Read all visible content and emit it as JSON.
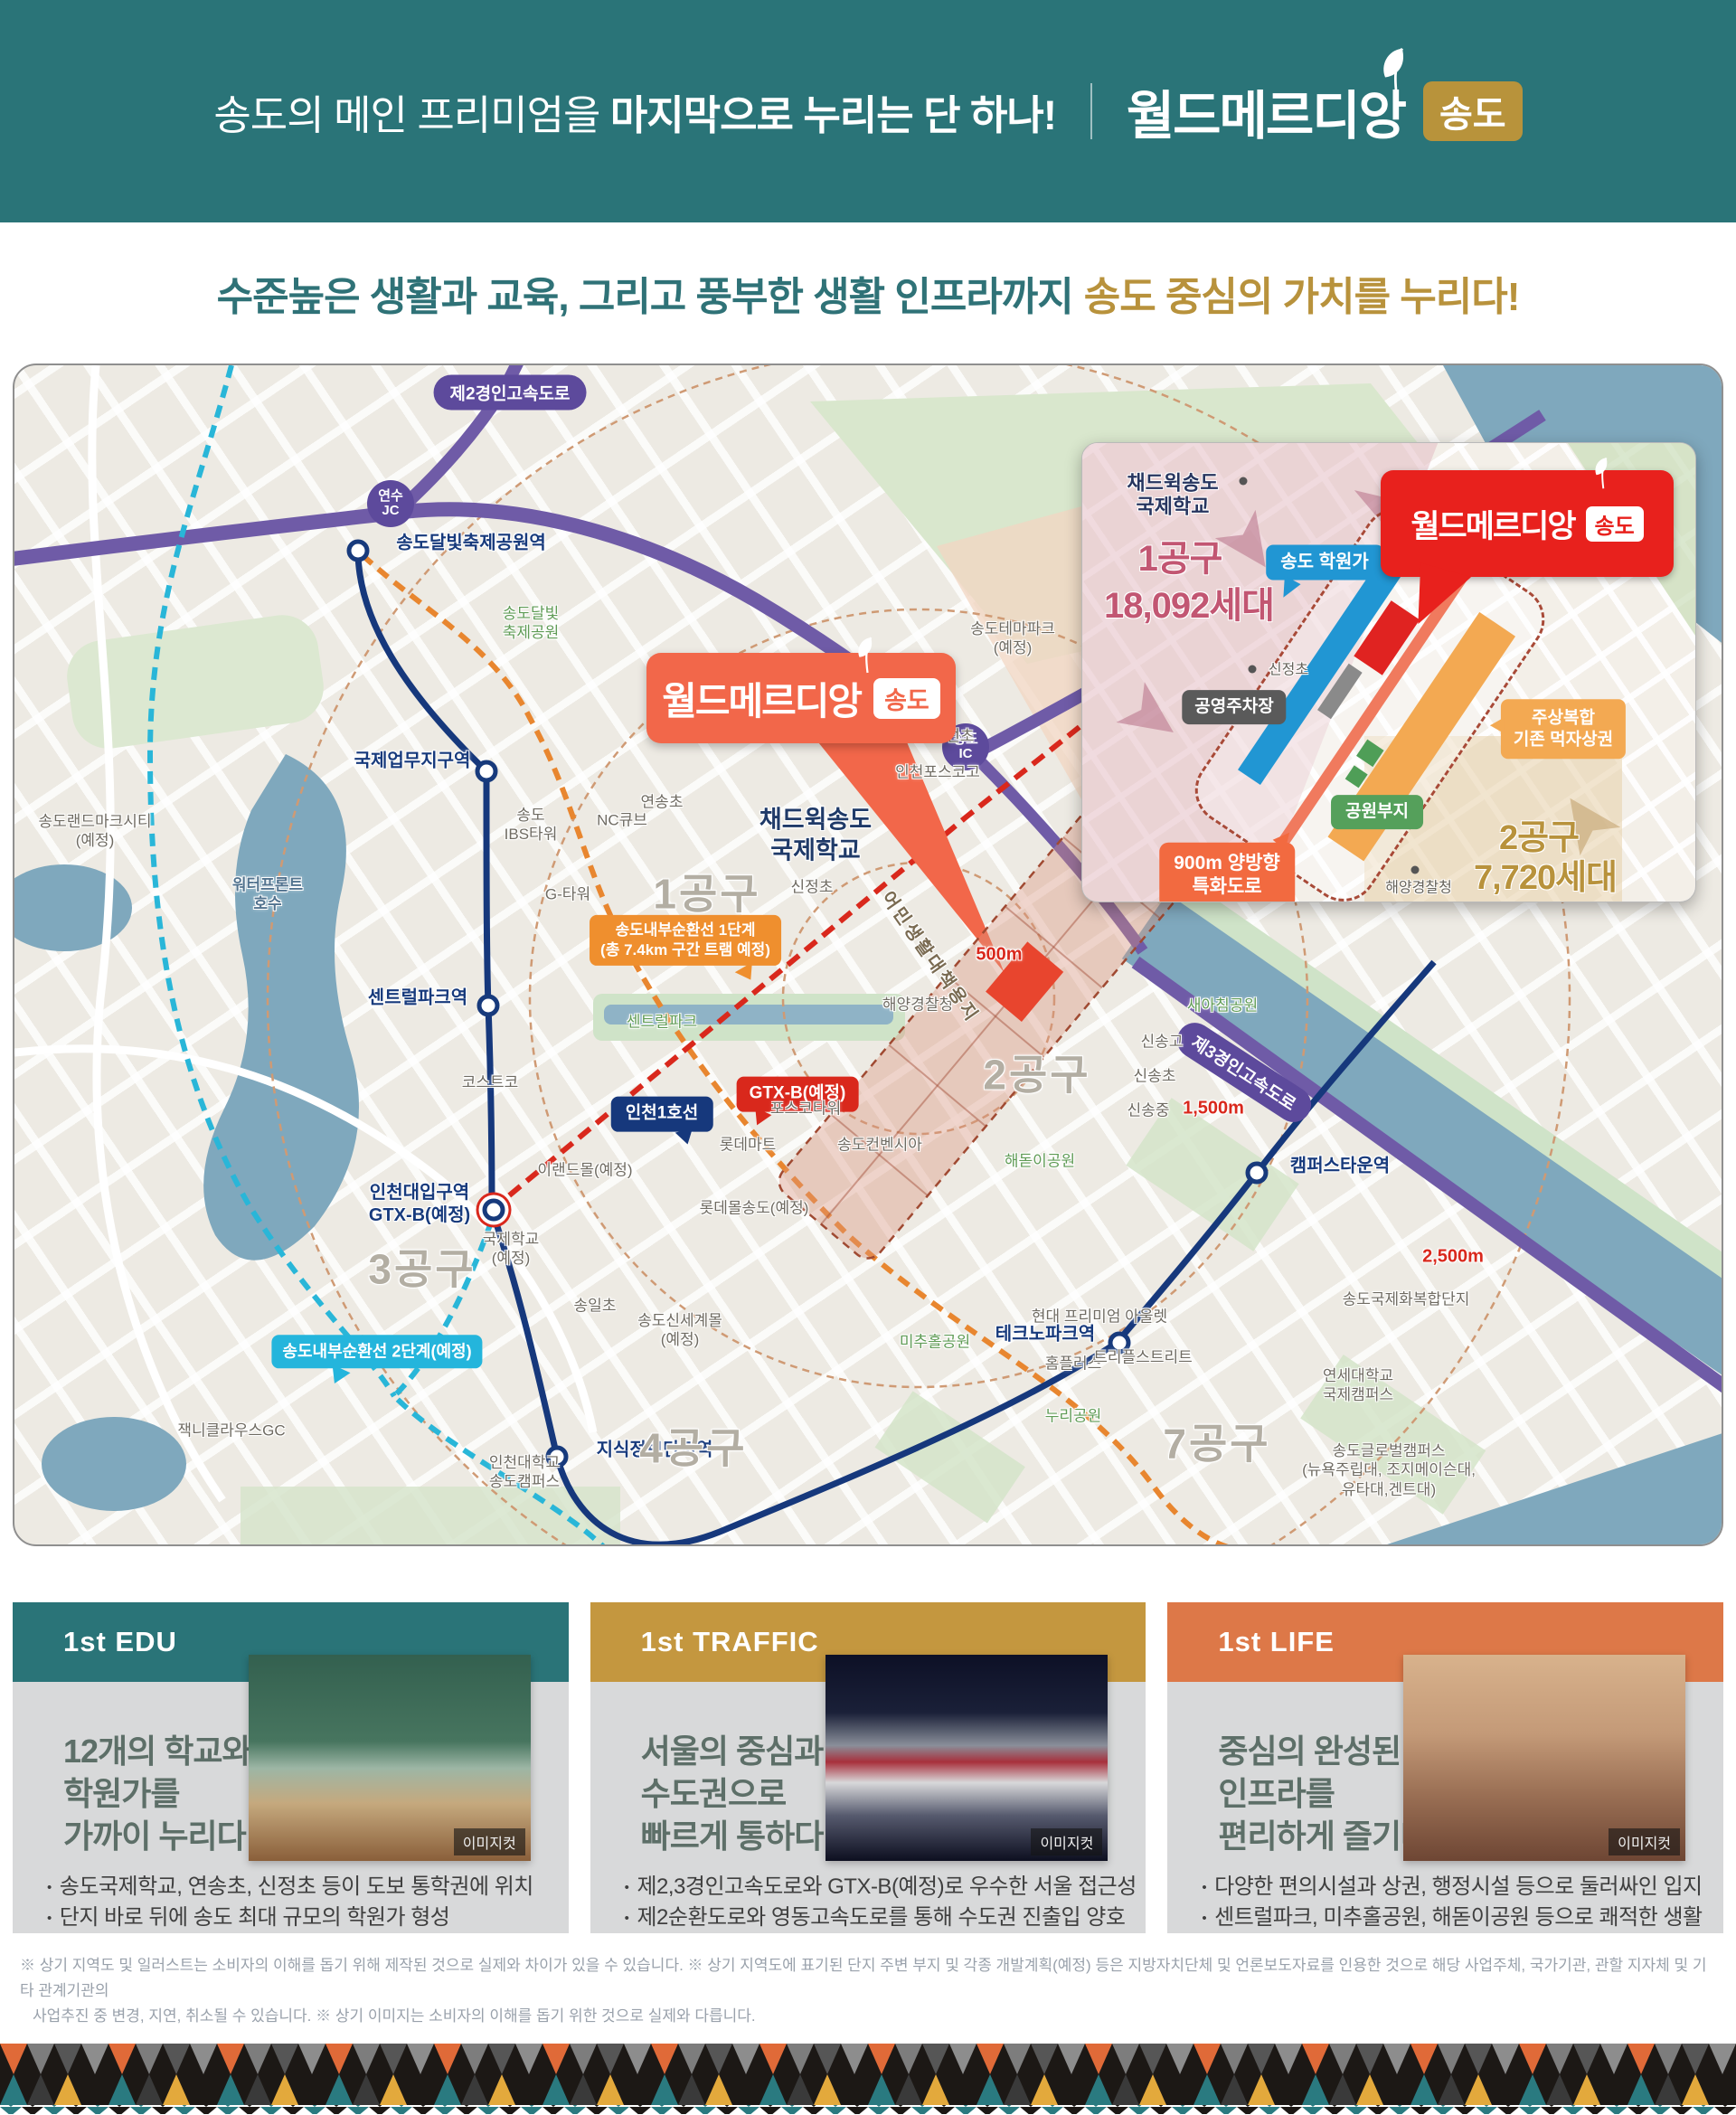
{
  "header": {
    "headline_regular": "송도의 메인 프리미엄을 ",
    "headline_bold": "마지막으로 누리는 단 하나!",
    "brand": "월드메르디앙",
    "brand_badge": "송도"
  },
  "subheadline": {
    "part_teal": "수준높은 생활과 교육, 그리고 풍부한 생활 인프라까지",
    "part_gold": "송도 중심의 가치를 누리다!"
  },
  "map": {
    "expressway2_badge": "제2경인고속도로",
    "expressway3_badge": "제3경인고속도로",
    "junction_yeonsu": "연수\nJC",
    "junction_songdo": "송도\nIC",
    "line1_badge": "인천1호선",
    "gtxb_badge": "GTX-B(예정)",
    "tram1_label": "송도내부순환선 1단계\n(총 7.4km 구간 트램 예정)",
    "tram2_label": "송도내부순환선 2단계(예정)",
    "callout": {
      "brand": "월드메르디앙",
      "badge": "송도"
    },
    "rings": {
      "r500": "500m",
      "r1500": "1,500m",
      "r2500": "2,500m"
    },
    "districts": {
      "d1": "1공구",
      "d2": "2공구",
      "d3": "3공구",
      "d4": "4공구",
      "d7": "7공구"
    },
    "stations": {
      "moonlight": "송도달빛축제공원역",
      "intl_biz": "국제업무지구역",
      "central_park": "센트럴파크역",
      "incheon_univ": "인천대입구역\nGTX-B(예정)",
      "knowledge": "지식정보단지역",
      "technopark": "테크노파크역",
      "campus_town": "캠퍼스타운역"
    },
    "places": {
      "landmark_city": "송도랜드마크시티\n(예정)",
      "waterfront": "워터프론트\n호수",
      "ibs_tower": "송도\nIBS타워",
      "nc_cube": "NC큐브",
      "g_tower": "G-타워",
      "yeonsong": "연송초",
      "myeongseon": "명선초",
      "posco_high": "인천포스코고",
      "sinjeong": "신정초",
      "costco": "코스트코",
      "eland": "이랜드몰(예정)",
      "intl_school": "국제학교\n(예정)",
      "songil": "송일초",
      "shinsegae": "송도신세계몰\n(예정)",
      "jack_nicklaus": "잭니클라우스GC",
      "incheon_univ_campus": "인천대학교\n송도캠퍼스",
      "posco_tower": "포스코타워",
      "lotte_mart": "롯데마트",
      "convensia": "송도컨벤시아",
      "lotte_mall": "롯데몰송도(예정)",
      "homeplus": "홈플러스",
      "triple_street": "트리플스트리트",
      "hyundai_outlet": "현대 프리미엄 아울렛",
      "sinsong_high": "신송고",
      "sinsong_elem": "신송초",
      "sinsong_mid": "신송중",
      "coast_guard": "해양경찰청",
      "theme_park": "송도테마파크\n(예정)",
      "intl_complex": "송도국제화복합단지",
      "yonsei": "연세대학교\n국제캠퍼스",
      "global_campus": "송도글로벌캠퍼스\n(뉴욕주립대, 조지메이슨대,\n유타대,겐트대)",
      "fisherman_site": "어민생활대책용지",
      "chadwick": "채드윅송도\n국제학교"
    },
    "parks": {
      "moonlight_park": "송도달빛\n축제공원",
      "central_park": "센트럴파크",
      "haedoji": "해돋이공원",
      "michuhol": "미추홀공원",
      "nuri": "누리공원",
      "saeachim": "새아침공원"
    }
  },
  "inset": {
    "school": "채드윅송도\n국제학교",
    "district1": "1공구",
    "district1_units": "18,092세대",
    "academy": "송도 학원가",
    "callout": {
      "brand": "월드메르디앙",
      "badge": "송도"
    },
    "sinjeong": "신정초",
    "parking": "공영주차장",
    "mixed_use": "주상복합\n기존 먹자상권",
    "park_site": "공원부지",
    "special_road": "900m 양방향\n특화도로",
    "coast_guard": "해양경찰청",
    "district2": "2공구",
    "district2_units": "7,720세대"
  },
  "cards": [
    {
      "tag": "1st EDU",
      "title": "12개의 학교와\n학원가를\n가까이 누리다",
      "image_caption": "이미지컷",
      "bullets": [
        "송도국제학교, 연송초, 신정초 등이 도보 통학권에 위치",
        "단지 바로 뒤에 송도 최대 규모의 학원가 형성"
      ]
    },
    {
      "tag": "1st TRAFFIC",
      "title": "서울의 중심과\n수도권으로\n빠르게 통하다",
      "image_caption": "이미지컷",
      "bullets": [
        "제2,3경인고속도로와 GTX-B(예정)로 우수한 서울 접근성",
        "제2순환도로와 영동고속도로를 통해 수도권 진출입 양호"
      ]
    },
    {
      "tag": "1st LIFE",
      "title": "중심의 완성된\n인프라를\n편리하게 즐기다",
      "image_caption": "이미지컷",
      "bullets": [
        "다양한 편의시설과 상권, 행정시설 등으로 둘러싸인 입지",
        "센트럴파크, 미추홀공원, 해돋이공원 등으로 쾌적한 생활"
      ]
    }
  ],
  "disclaimer": {
    "line1": "※ 상기 지역도 및 일러스트는 소비자의 이해를 돕기 위해 제작된 것으로 실제와 차이가 있을 수 있습니다. ※ 상기 지역도에 표기된 단지 주변 부지 및 각종 개발계획(예정) 등은 지방자치단체 및 언론보도자료를 인용한 것으로 해당 사업주체, 국가기관, 관할 지자체 및 기타 관계기관의",
    "line2": "사업추진 중 변경, 지연, 취소될 수 있습니다. ※ 상기 이미지는 소비자의 이해를 돕기 위한 것으로 실제와 다릅니다."
  },
  "colors": {
    "teal": "#2a7478",
    "gold": "#b8923c",
    "card_gold": "#c4973f",
    "card_orange": "#dd7848",
    "accent_red": "#e8211d",
    "callout_orange": "#f2674a"
  }
}
